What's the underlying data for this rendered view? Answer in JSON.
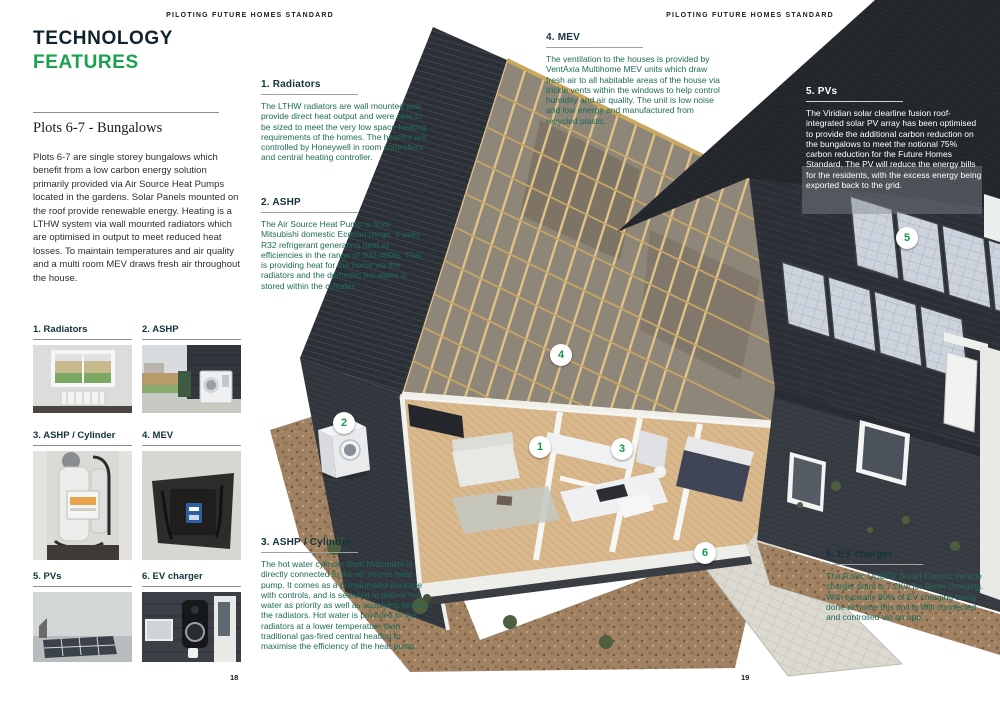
{
  "page": {
    "left_header": "PILOTING FUTURE HOMES STANDARD",
    "right_header": "PILOTING FUTURE HOMES STANDARD",
    "left_page_number": "18",
    "right_page_number": "19"
  },
  "title": {
    "line1": "TECHNOLOGY",
    "line2": "FEATURES"
  },
  "subtitle": "Plots 6-7 - Bungalows",
  "intro": "Plots 6-7 are single storey bungalows which benefit from a low carbon energy solution primarily provided via Air Source Heat Pumps located in the gardens. Solar Panels mounted on the roof provide renewable energy. Heating is a LTHW system via wall mounted radiators which are optimised in output to meet reduced heat losses. To maintain temperatures and air quality and a multi room MEV draws fresh air throughout the house.",
  "sections": [
    {
      "heading": "1. Radiators",
      "body": "The LTHW radiators are wall mounted and provide direct heat output and were able to be sized to meet the very low space heating requirements of the homes. The heaters are controlled by Honeywell in room controllers and central heating controller."
    },
    {
      "heading": "2. ASHP",
      "body": "The Air Source Heat Pump is from Mitsubishi domestic Ecodan range. It uses R32 refrigerant generating heat at efficiencies in the range of 300-400%. This is providing heat for the home via the radiators and the domestic hot water is stored within the cylinder."
    },
    {
      "heading": "3. ASHP / Cylinder",
      "body": "The hot water cylinder from Mitsubishi is directly connected to the air source heat pump. It comes as a pre-plumbed package with controls, and is selected to deliver hot water as priority as well as supplying heat to the radiators.  Hot water is provided to the radiators at a lower temperature than traditional gas-fired central heating to maximise the efficiency of the heat pump."
    },
    {
      "heading": "4. MEV",
      "body": "The ventilation to the houses is provided by VentAxia Multihome MEV units which draw fresh air to all habitable areas of the house via trickle vents within the windows to help control humidity and air quality. The unit is low noise and low energy and manufactured from recycled plastic."
    },
    {
      "heading": "5. PVs",
      "body": "The Viridian solar clearline fusion roof-integrated solar PV array has been optimised to provide the additional carbon reduction on the bungalows to meet the notional 75% carbon reduction for the Future Homes Standard. The PV will reduce the energy bills for the residents, with the excess energy being exported back to the grid."
    },
    {
      "heading": "6. EV charger",
      "body": "The Rolec QUBEV Smart Electric Vehicle charger point is 7.2Kw for faster charging. With typically 80% of EV charging being done at home this unit is Wifi connected and controlled via an app."
    }
  ],
  "thumbnails": [
    {
      "label": "1. Radiators"
    },
    {
      "label": "2. ASHP"
    },
    {
      "label": "3. ASHP / Cylinder"
    },
    {
      "label": "4. MEV"
    },
    {
      "label": "5. PVs"
    },
    {
      "label": "6. EV charger"
    }
  ],
  "markers": [
    "1",
    "2",
    "3",
    "4",
    "5",
    "6"
  ],
  "colors": {
    "accent_green": "#1aa14e",
    "body_teal": "#1d6b57",
    "heading_dark": "#14333c",
    "roof_dark": "#2c3036",
    "truss_gold": "#dcbe86"
  }
}
